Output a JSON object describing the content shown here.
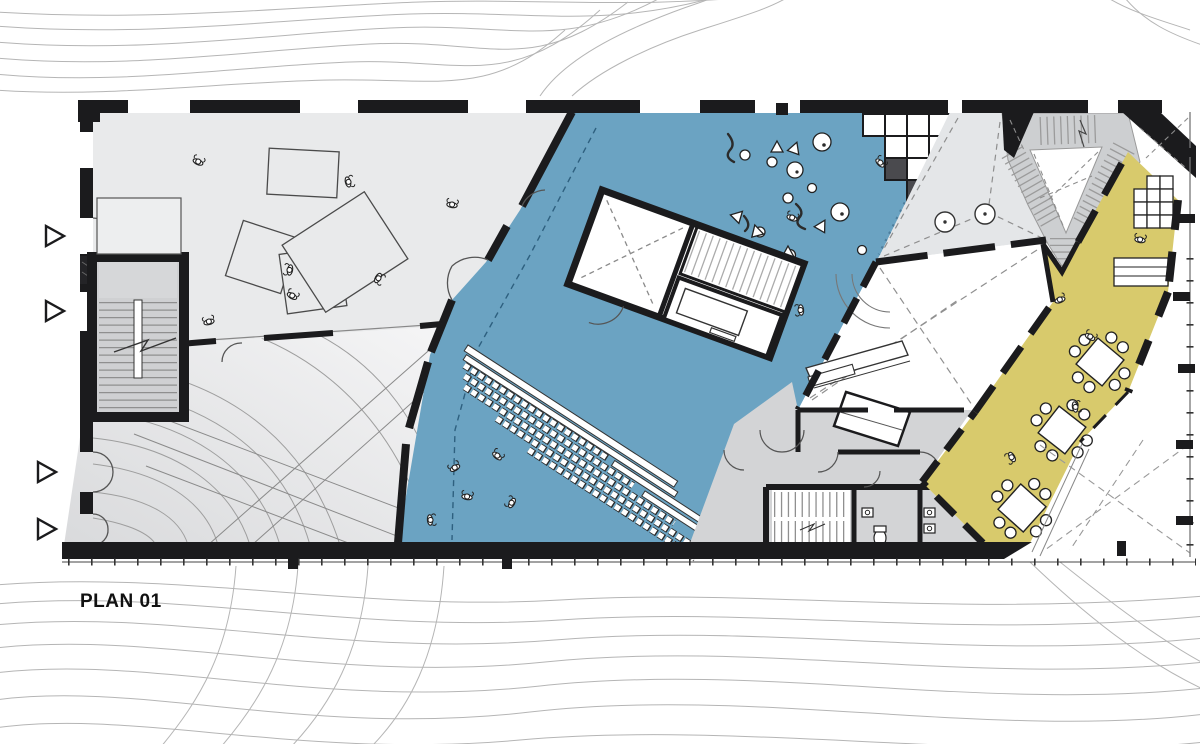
{
  "title": "PLAN 01",
  "colors": {
    "auditorium": "#6BA3C2",
    "cafe": "#D8CA6C",
    "exhibition": "#E9EAEB",
    "gallery_wedge": "#E4E6E8",
    "stair": "#CDCFD1",
    "service": "#D3D4D6",
    "wall": "#1B1B1D",
    "contour": "#B5B5B5",
    "ramp_light": "#F5F5F6",
    "ramp_dark": "#D9DADC",
    "furniture_line": "#3A3A3A",
    "tread": "#979797",
    "dashed_guide": "#8E8E8E"
  }
}
